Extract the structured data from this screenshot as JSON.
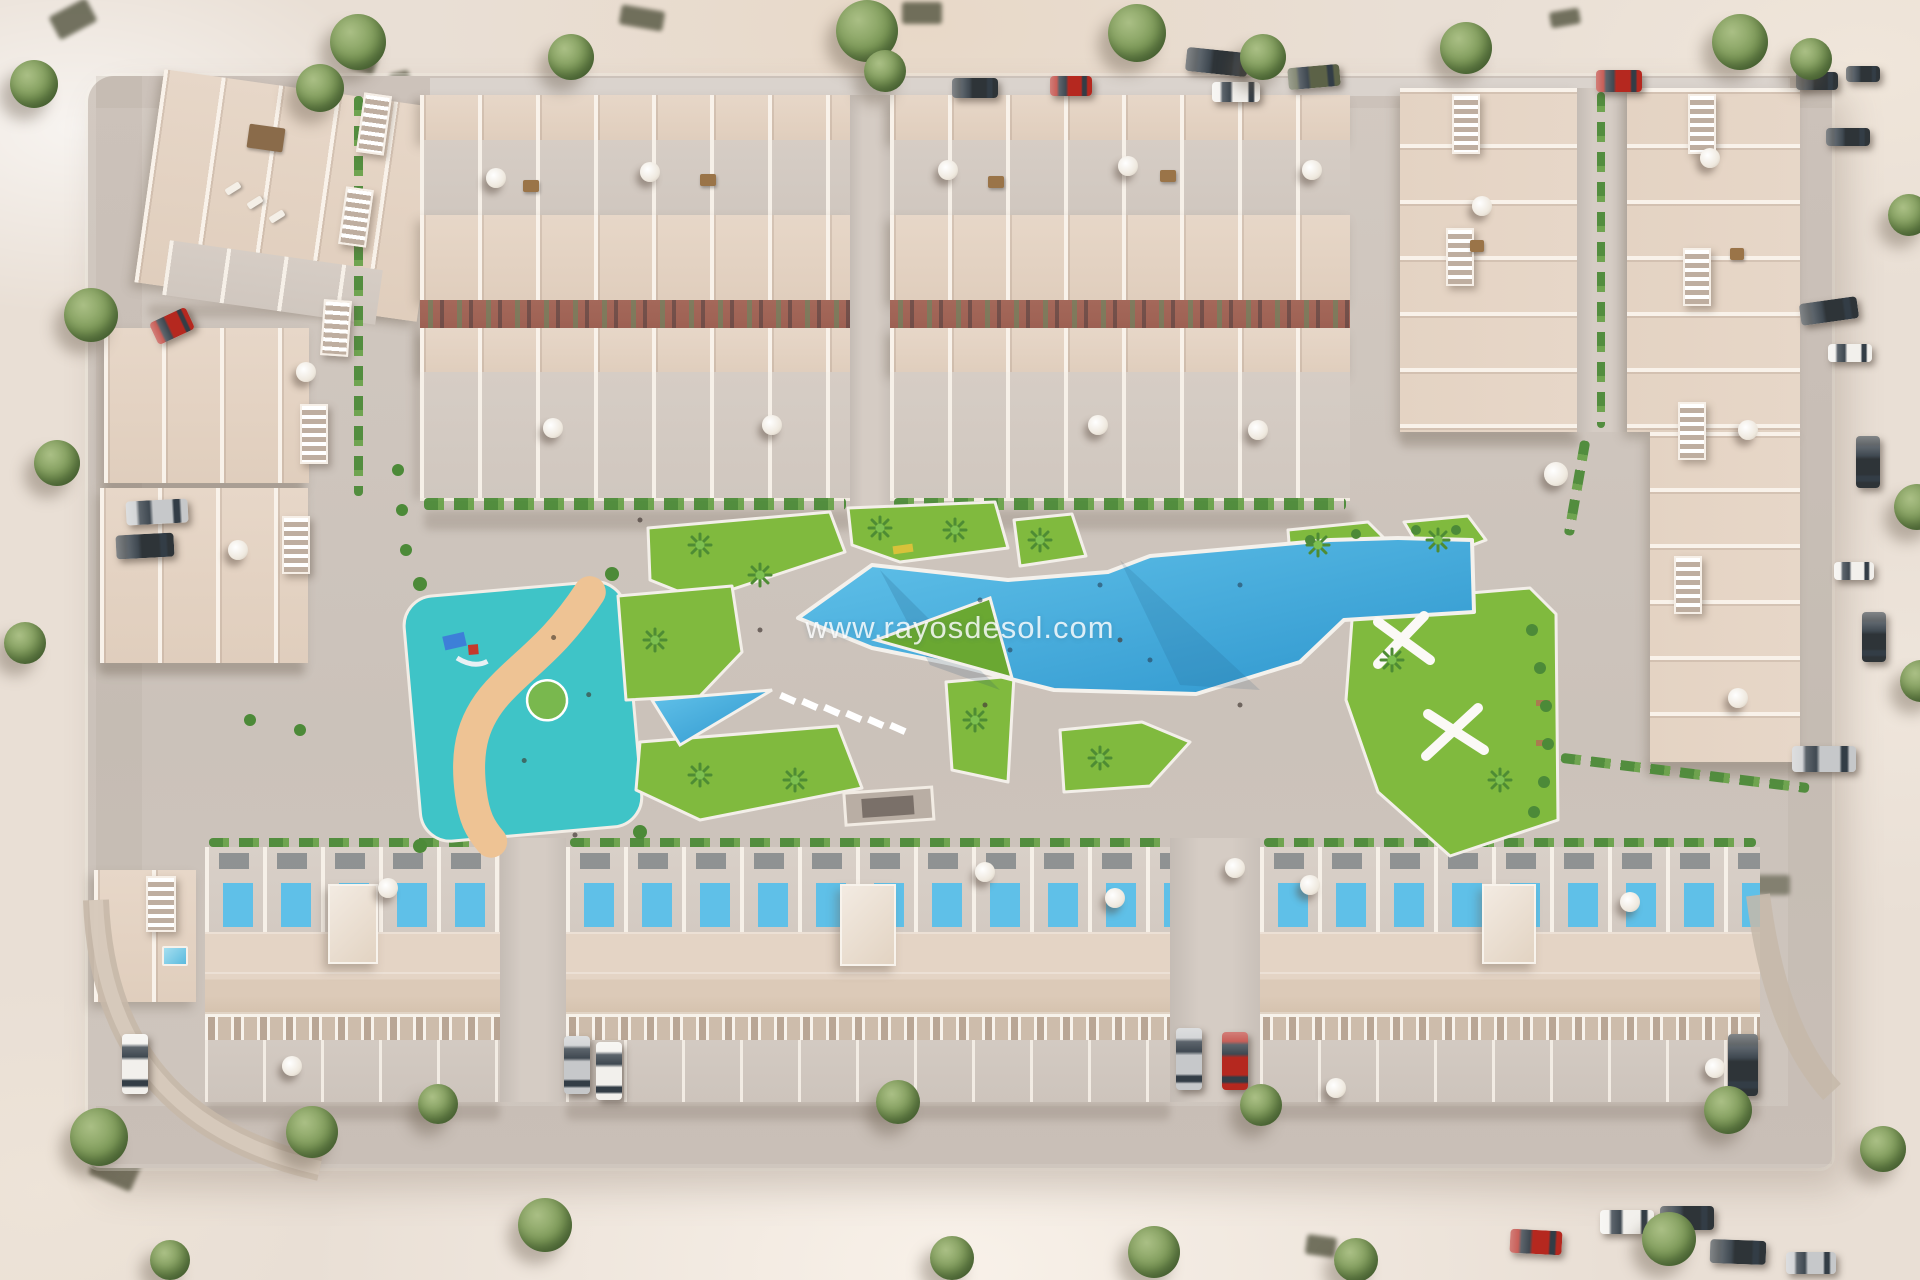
{
  "scene": {
    "type": "aerial-3d-architectural-render",
    "subject": "Bird's-eye 3D render of a residential development: perimeter townhouse blocks with roof terraces around a central amenity area with lagoon pool, children's pool, splash water park, lawned gardens and street parking",
    "watermark": "www.rayosdesol.com"
  },
  "palette": {
    "terrain": "#e9dfd5",
    "pavement": "#d0c7bf",
    "roof": "#e7d7c8",
    "terrace": "#d6cdc5",
    "wall_white": "#f4ede5",
    "facade_band": "#9e6153",
    "grass": "#80ba3e",
    "grass_deep": "#6aa832",
    "hedge": "#4c8a38",
    "pool_light": "#5fc0e8",
    "pool_deep": "#2d95cd",
    "splash_teal": "#3fc4c7",
    "sand": "#eec394",
    "tree": "#7d9a58",
    "umbrella": "#efe9df",
    "car_red": "#b5281f",
    "car_white": "#f2f0ec",
    "car_silver": "#c6c8ca",
    "car_dark": "#2e3438",
    "car_green": "#5c6247"
  },
  "features": [
    "townhouse-blocks-with-roof-terraces",
    "apartment-corner-blocks",
    "main-lagoon-pool",
    "children-pool",
    "splash-water-park-with-slide-and-sand-path",
    "central-lawns-with-palms",
    "fitness-garden-with-white-benches",
    "rooftop-plunge-pools",
    "street-parking-with-cars",
    "perimeter-roads-with-trees"
  ]
}
